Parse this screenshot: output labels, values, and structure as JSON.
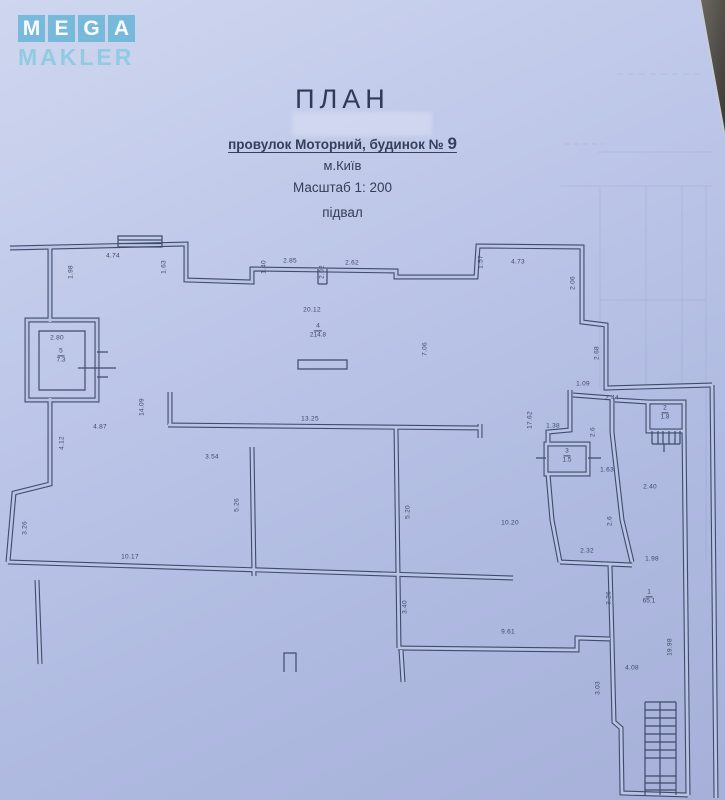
{
  "watermark": {
    "letters": [
      "M",
      "E",
      "G",
      "A"
    ],
    "word": "MAKLER"
  },
  "title_block": {
    "title": "ПЛАН",
    "address_prefix": "провулок Моторний,  будинок № ",
    "address_number": "9",
    "city": "м.Київ",
    "scale": "Масштаб 1: 200",
    "floor": "підвал"
  },
  "colors": {
    "paper": "#b8c2e6",
    "plan_line": "#3f4b6b",
    "logo_box": "#56b0d4",
    "logo_letter": "#ffffff",
    "logo_word": "#88c9e2",
    "photo_background_corner": "#4a4641"
  },
  "plan": {
    "dimension_labels": [
      {
        "text": "4.74",
        "x": 113,
        "y": 256,
        "v": false
      },
      {
        "text": "2.85",
        "x": 290,
        "y": 261,
        "v": false
      },
      {
        "text": "2.62",
        "x": 352,
        "y": 263,
        "v": false
      },
      {
        "text": "4.73",
        "x": 518,
        "y": 262,
        "v": false
      },
      {
        "text": "1.63",
        "x": 164,
        "y": 267,
        "v": true
      },
      {
        "text": "1.40",
        "x": 264,
        "y": 267,
        "v": true
      },
      {
        "text": "2.02",
        "x": 322,
        "y": 272,
        "v": true
      },
      {
        "text": "1.57",
        "x": 481,
        "y": 262,
        "v": true
      },
      {
        "text": "1.98",
        "x": 71,
        "y": 272,
        "v": true
      },
      {
        "text": "2.06",
        "x": 573,
        "y": 283,
        "v": true
      },
      {
        "text": "2.68",
        "x": 597,
        "y": 353,
        "v": true
      },
      {
        "text": "20.12",
        "x": 312,
        "y": 310,
        "v": false
      },
      {
        "text": "7.06",
        "x": 425,
        "y": 349,
        "v": true
      },
      {
        "text": "17.62",
        "x": 530,
        "y": 420,
        "v": true
      },
      {
        "text": "2.80",
        "x": 57,
        "y": 338,
        "v": false
      },
      {
        "text": "14.09",
        "x": 142,
        "y": 407,
        "v": true
      },
      {
        "text": "4.87",
        "x": 100,
        "y": 427,
        "v": false
      },
      {
        "text": "13.25",
        "x": 310,
        "y": 419,
        "v": false
      },
      {
        "text": "3.54",
        "x": 212,
        "y": 457,
        "v": false
      },
      {
        "text": "4.12",
        "x": 62,
        "y": 443,
        "v": true
      },
      {
        "text": "3.26",
        "x": 25,
        "y": 528,
        "v": true
      },
      {
        "text": "5.26",
        "x": 237,
        "y": 505,
        "v": true
      },
      {
        "text": "5.20",
        "x": 408,
        "y": 512,
        "v": true
      },
      {
        "text": "10.17",
        "x": 130,
        "y": 557,
        "v": false
      },
      {
        "text": "10.20",
        "x": 510,
        "y": 523,
        "v": false
      },
      {
        "text": "2.32",
        "x": 587,
        "y": 551,
        "v": false
      },
      {
        "text": "1.98",
        "x": 652,
        "y": 559,
        "v": false
      },
      {
        "text": "9.61",
        "x": 508,
        "y": 632,
        "v": false
      },
      {
        "text": "3.40",
        "x": 405,
        "y": 607,
        "v": true
      },
      {
        "text": "4.08",
        "x": 632,
        "y": 668,
        "v": false
      },
      {
        "text": "3.03",
        "x": 598,
        "y": 688,
        "v": true
      },
      {
        "text": "19.98",
        "x": 670,
        "y": 647,
        "v": true
      },
      {
        "text": "1.09",
        "x": 583,
        "y": 384,
        "v": false
      },
      {
        "text": "2.44",
        "x": 612,
        "y": 398,
        "v": false
      },
      {
        "text": "1.38",
        "x": 553,
        "y": 426,
        "v": false
      },
      {
        "text": "2.6",
        "x": 593,
        "y": 432,
        "v": true
      },
      {
        "text": "1.63",
        "x": 607,
        "y": 470,
        "v": false
      },
      {
        "text": "2.40",
        "x": 650,
        "y": 487,
        "v": false
      },
      {
        "text": "2.6",
        "x": 610,
        "y": 521,
        "v": true
      },
      {
        "text": "3.26",
        "x": 609,
        "y": 598,
        "v": true
      }
    ],
    "room_labels": [
      {
        "number": "5",
        "area": "7.3",
        "x": 61,
        "y": 356
      },
      {
        "number": "4",
        "area": "214.8",
        "x": 318,
        "y": 331
      },
      {
        "number": "2",
        "area": "1.8",
        "x": 665,
        "y": 413
      },
      {
        "number": "3",
        "area": "1.5",
        "x": 567,
        "y": 456
      },
      {
        "number": "1",
        "area": "65.1",
        "x": 649,
        "y": 597
      }
    ]
  }
}
